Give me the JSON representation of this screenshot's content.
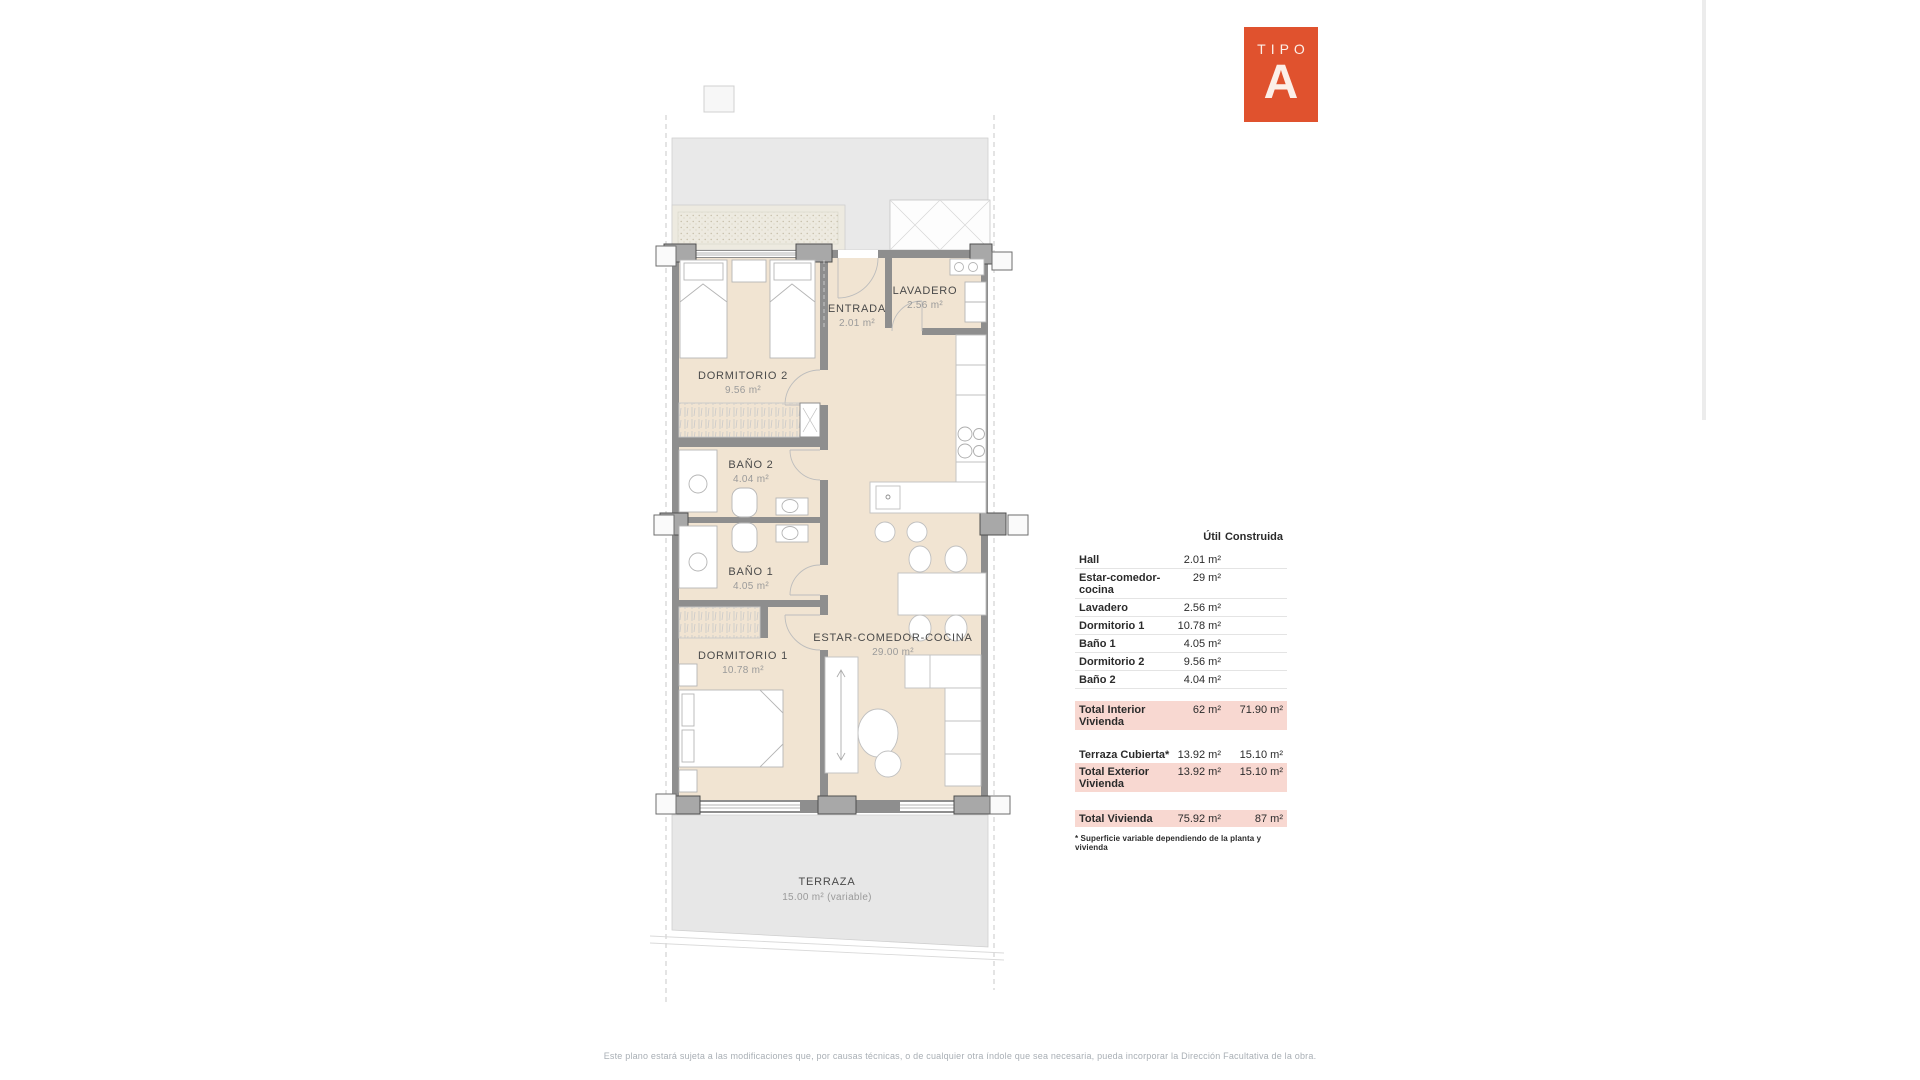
{
  "badge": {
    "label": "TIPO",
    "letter": "A",
    "color": "#E0522E"
  },
  "plan": {
    "rooms": [
      {
        "name": "DORMITORIO 2",
        "area": "9.56 m²"
      },
      {
        "name": "ENTRADA",
        "area": "2.01 m²"
      },
      {
        "name": "LAVADERO",
        "area": "2.56 m²"
      },
      {
        "name": "BAÑO 2",
        "area": "4.04 m²"
      },
      {
        "name": "BAÑO 1",
        "area": "4.05 m²"
      },
      {
        "name": "DORMITORIO 1",
        "area": "10.78 m²"
      },
      {
        "name": "ESTAR-COMEDOR-COCINA",
        "area": "29.00 m²"
      },
      {
        "name": "TERRAZA",
        "area": "15.00 m² (variable)"
      }
    ],
    "colors": {
      "room_fill": "#F1E4D2",
      "roof_gray": "#E9E9E9",
      "terrace_gray": "#E7E7E7",
      "wall": "#8E8E8E"
    }
  },
  "table": {
    "headers": {
      "util": "Útil",
      "construida": "Construida"
    },
    "rows": [
      {
        "label": "Hall",
        "util": "2.01 m²",
        "construida": ""
      },
      {
        "label": "Estar-comedor-cocina",
        "util": "29 m²",
        "construida": ""
      },
      {
        "label": "Lavadero",
        "util": "2.56 m²",
        "construida": ""
      },
      {
        "label": "Dormitorio 1",
        "util": "10.78 m²",
        "construida": ""
      },
      {
        "label": "Baño 1",
        "util": "4.05 m²",
        "construida": ""
      },
      {
        "label": "Dormitorio 2",
        "util": "9.56 m²",
        "construida": ""
      },
      {
        "label": "Baño 2",
        "util": "4.04 m²",
        "construida": ""
      }
    ],
    "totals": [
      {
        "label": "Total Interior Vivienda",
        "util": "62 m²",
        "construida": "71.90 m²"
      },
      {
        "label": "Terraza Cubierta*",
        "util": "13.92 m²",
        "construida": "15.10 m²"
      },
      {
        "label": "Total Exterior Vivienda",
        "util": "13.92 m²",
        "construida": "15.10 m²"
      },
      {
        "label": "Total Vivienda",
        "util": "75.92 m²",
        "construida": "87 m²"
      }
    ],
    "footnote": "* Superficie variable dependiendo de la planta y vivienda",
    "highlight_color": "#F8D8D1"
  },
  "footer": {
    "disclaimer": "Este plano estará sujeta a las modificaciones que, por causas técnicas, o de cualquier otra índole que sea necesaria, pueda incorporar la Dirección Facultativa de la obra."
  }
}
